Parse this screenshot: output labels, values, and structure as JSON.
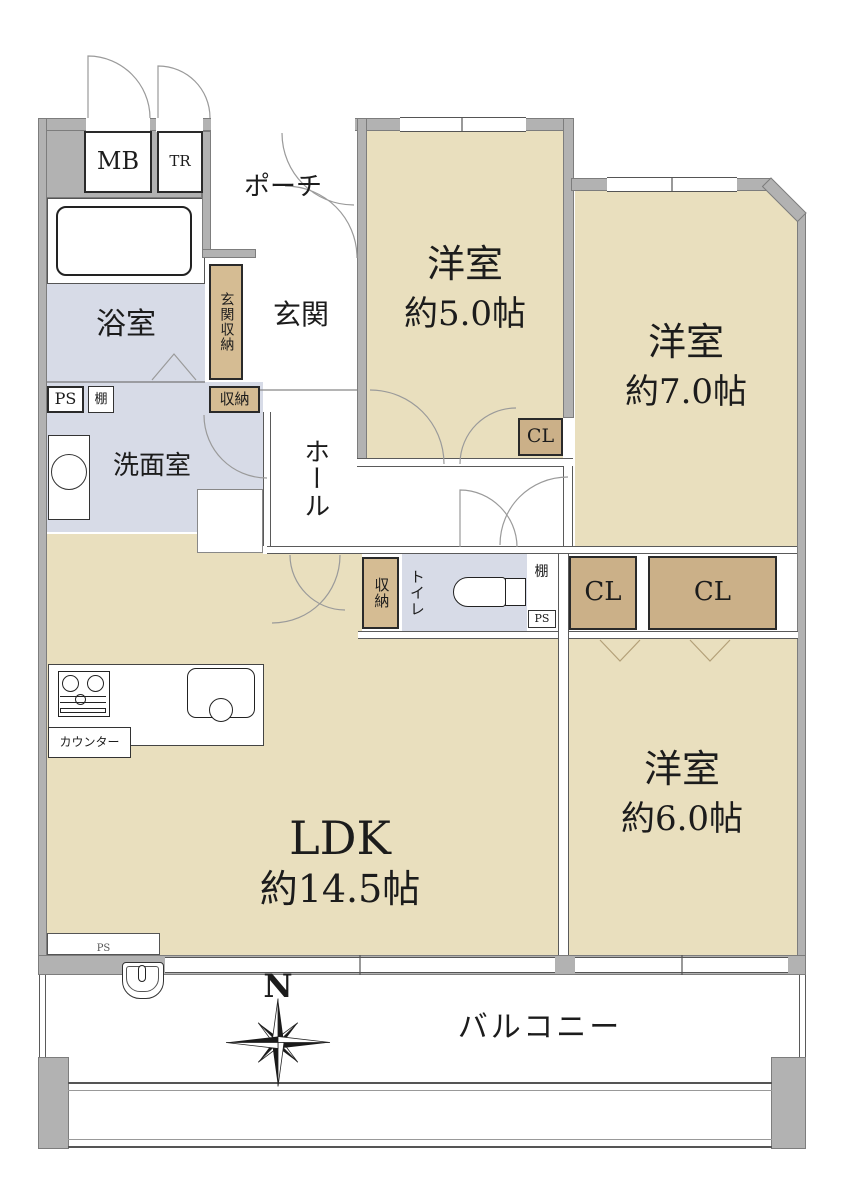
{
  "labels": {
    "mb": "MB",
    "tr": "TR",
    "porch": "ポーチ",
    "bath": "浴室",
    "entrance_storage": "玄関収納",
    "entrance": "玄関",
    "room5_name": "洋室",
    "room5_size": "約5.0帖",
    "cl_small": "CL",
    "room7_name": "洋室",
    "room7_size": "約7.0帖",
    "ps_left": "PS",
    "shelf_left": "棚",
    "washroom": "洗面室",
    "storage_top": "収納",
    "hall": "ホール",
    "storage_mid": "収納",
    "toilet": "トイレ",
    "shelf_mid": "棚",
    "ps_mid": "PS",
    "cl_left": "CL",
    "cl_right": "CL",
    "room6_name": "洋室",
    "room6_size": "約6.0帖",
    "ldk_name": "LDK",
    "ldk_size": "約14.5帖",
    "counter": "カウンター",
    "ps_bottom": "PS",
    "balcony": "バルコニー",
    "compass_north": "N"
  },
  "colors": {
    "room_fill": "#e9dfbe",
    "closet_fill": "#cbb088",
    "storage_fill": "#d5bc93",
    "wet_area_fill": "#d7dbe7",
    "wall_fill": "#b2b2b2"
  }
}
